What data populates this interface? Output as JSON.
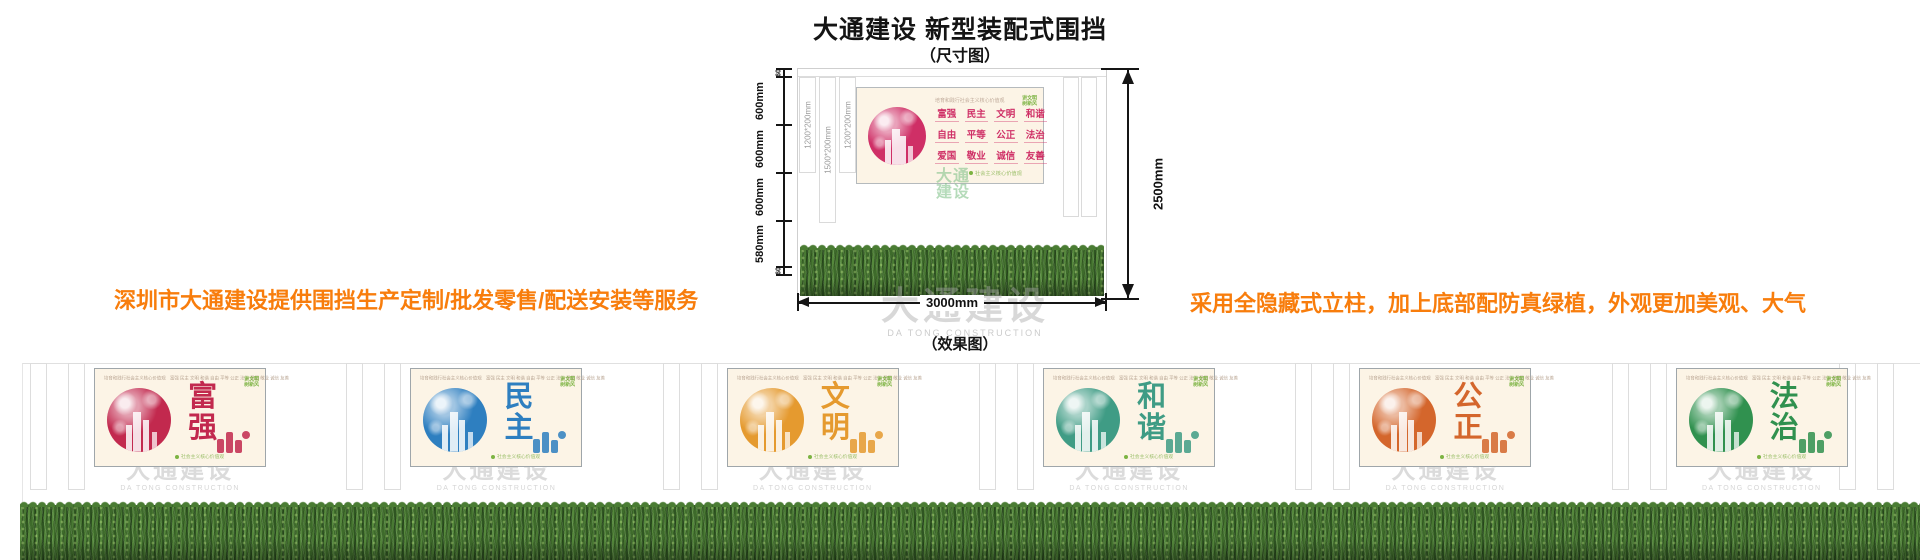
{
  "title": "大通建设 新型装配式围挡",
  "size_caption": "（尺寸图）",
  "effect_caption": "（效果图）",
  "note_left": "深圳市大通建设提供围挡生产定制/批发零售/配送安装等服务",
  "note_right": "采用全隐藏式立柱，加上底部配防真绿植，外观更加美观、大气",
  "dimensions": {
    "left_segments": [
      "60",
      "600mm",
      "600mm",
      "600mm",
      "580mm",
      "60"
    ],
    "height_total": "2500mm",
    "width_total": "3000mm",
    "post_labels": [
      "1200*200mm",
      "1500*200mm",
      "1200*200mm"
    ]
  },
  "billboard": {
    "header": "培育和践行社会主义核心价值观",
    "badge_line1": "讲文明",
    "badge_line2": "树新风",
    "values": [
      "富强",
      "民主",
      "文明",
      "和谐",
      "自由",
      "平等",
      "公正",
      "法治",
      "爱国",
      "敬业",
      "诚信",
      "友善"
    ],
    "footnote": "社会主义核心价值观",
    "accent": "#cf2f66",
    "micro_strip": "培育和践行社会主义核心价值观　富强 民主 文明 和谐 自由 平等 公正 法治 爱国 敬业 诚信 友善"
  },
  "logo_watermark": {
    "line1": "大通",
    "line2": "建设"
  },
  "watermark": {
    "cn": "大通建设",
    "en": "DA TONG CONSTRUCTION"
  },
  "effect_panels": [
    {
      "name": "富强",
      "char1": "富",
      "char2": "强",
      "color": "#c2294e"
    },
    {
      "name": "民主",
      "char1": "民",
      "char2": "主",
      "color": "#2e7fc0"
    },
    {
      "name": "文明",
      "char1": "文",
      "char2": "明",
      "color": "#e59a2f"
    },
    {
      "name": "和谐",
      "char1": "和",
      "char2": "谐",
      "color": "#3f9c85"
    },
    {
      "name": "公正",
      "char1": "公",
      "char2": "正",
      "color": "#d4662c"
    },
    {
      "name": "法治",
      "char1": "法",
      "char2": "治",
      "color": "#30914f"
    }
  ],
  "colors": {
    "note_orange": "#f87d0c",
    "grass_green": "#456f33",
    "panel_cream": "#fcf4e6"
  }
}
